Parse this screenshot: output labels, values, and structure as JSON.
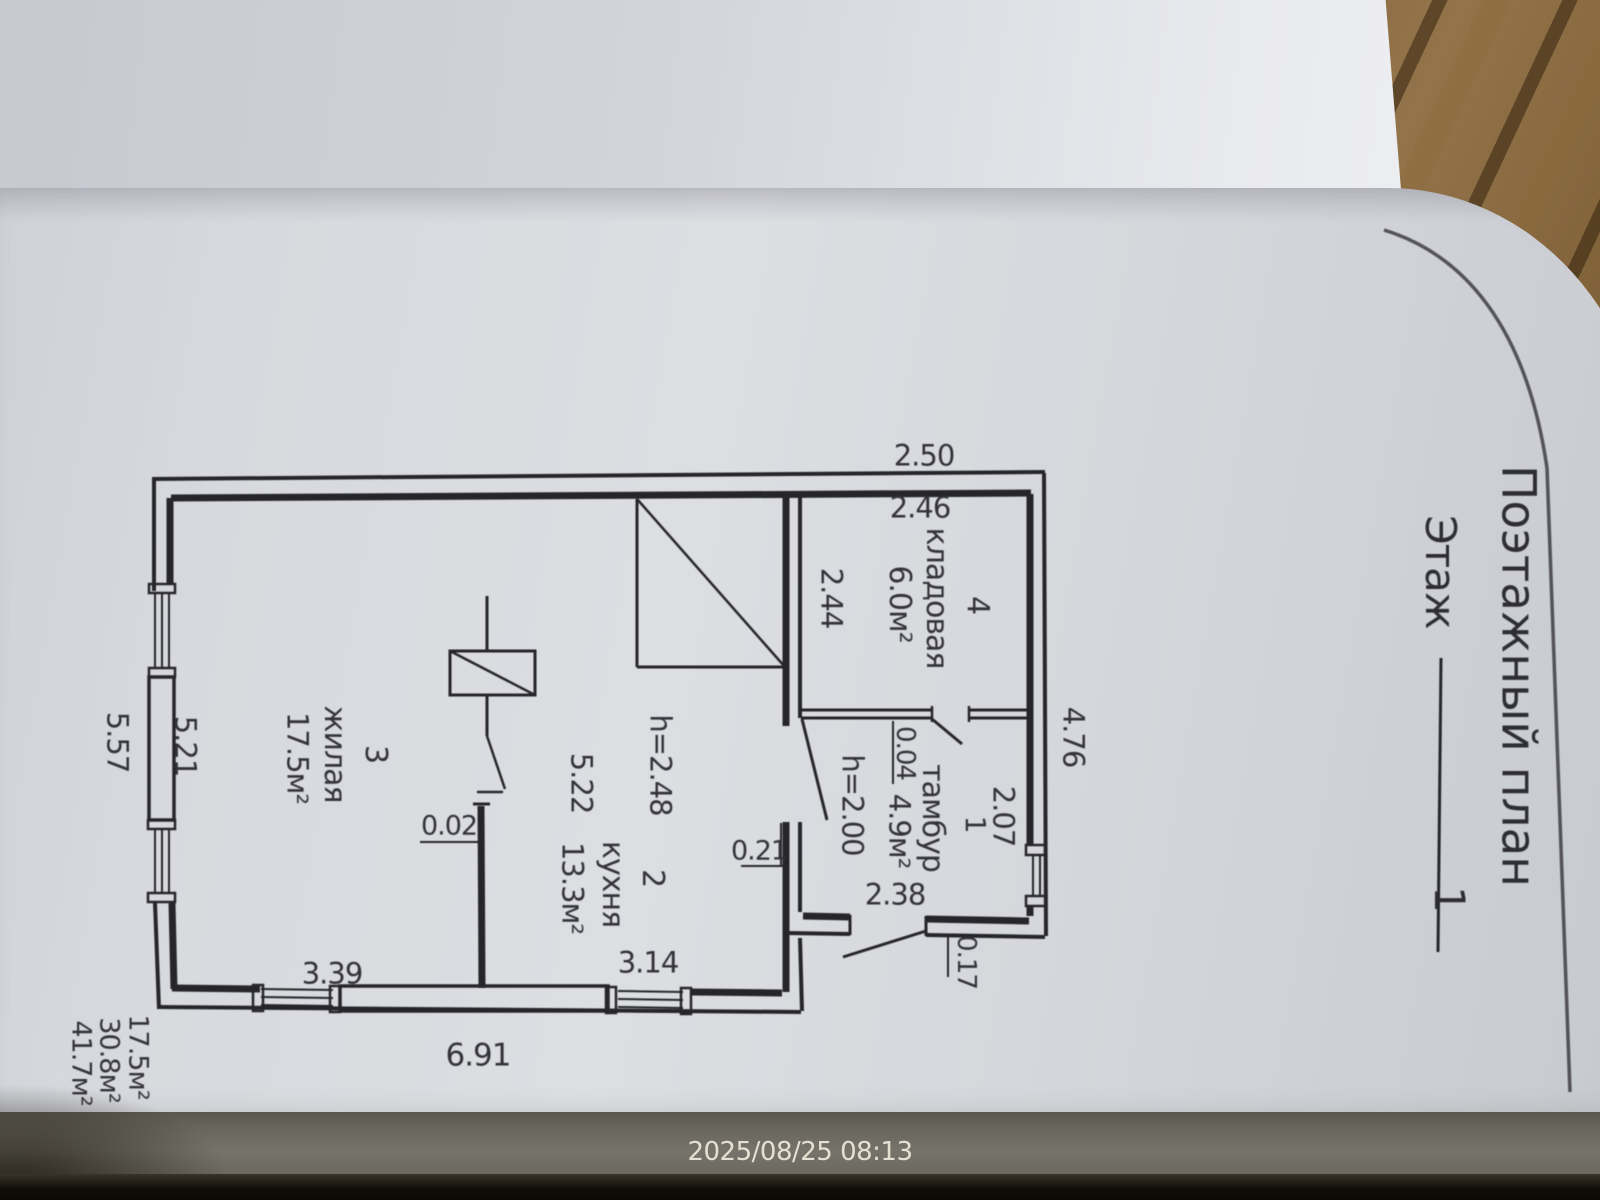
{
  "document": {
    "title": "Поэтажный план",
    "floor_label": "Этаж",
    "floor_value": "1"
  },
  "camera": {
    "timestamp": "2025/08/25 08:13"
  },
  "rooms": [
    {
      "number": "4",
      "name": "кладовая",
      "area": "6.0м²"
    },
    {
      "number": "1",
      "name": "тамбур",
      "area": "4.9м²",
      "height": "h=2.00"
    },
    {
      "number": "2",
      "name": "кухня",
      "area": "13.3м²",
      "height": "h=2.48"
    },
    {
      "number": "3",
      "name": "жилая",
      "area": "17.5м²"
    }
  ],
  "dimensions": {
    "ext_top_width": "2.50",
    "kladovaya_width": "2.46",
    "kladovaya_depth": "2.44",
    "ext_right_depth": "4.76",
    "tambur_width": "2.07",
    "tambur_gap": "0.04",
    "tambur_depth": "2.38",
    "wall_thickness": "0.21",
    "porch_step": "0.17",
    "house_side_outer": "5.57",
    "house_side_inner": "5.21",
    "kitchen_depth": "5.22",
    "kitchen_width": "3.14",
    "living_width": "3.39",
    "partition_thickness": "0.02",
    "house_front_outer": "6.91"
  },
  "totals": [
    "17.5м²",
    "30.8м²",
    "41.7м²"
  ],
  "colors": {
    "ink": "#26262a",
    "paper": "#dcdee2",
    "wood": "#8a6a3c",
    "table": "#76736b"
  }
}
